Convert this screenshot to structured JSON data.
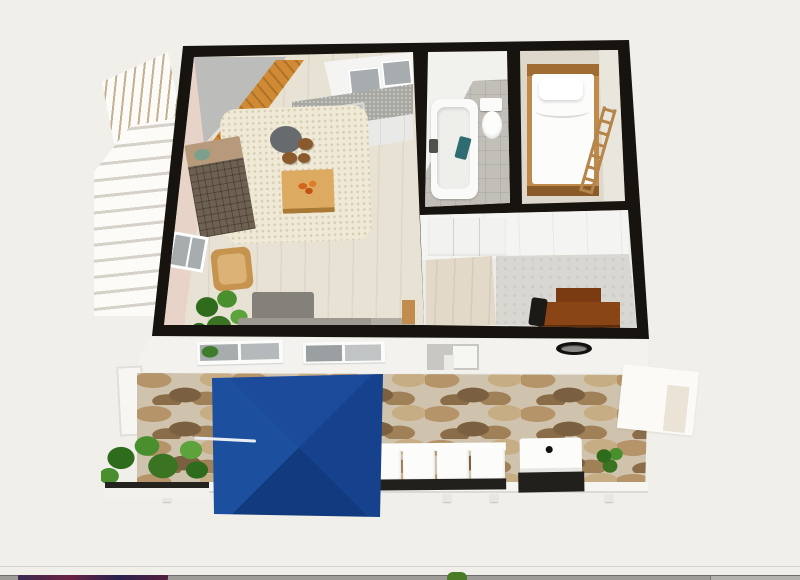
{
  "view": {
    "type": "3d-floor-plan-render",
    "background": "#f0efe9"
  },
  "colors": {
    "bg": "#f0efe9",
    "wall": "#17140f",
    "floor": "#e8e2d5",
    "pinkWall": "#e8d3c8",
    "ceiling": "#bcbcba",
    "stairs": "#cf8a33",
    "pergolaSlatGap": "#c2b193",
    "counter": "#a8a8a3",
    "cabinetFront": "#e9e9e7",
    "glass": "#a7adaf",
    "rug": "#efe9d6",
    "roundTable": "#686b6d",
    "stool": "#8a5a2c",
    "tableWood": "#dcaa60",
    "flowers": "#d4641c",
    "sideboardTop": "#b79a7c",
    "sideboardFront": "#6e6152",
    "sideboardPlant": "#7ca08c",
    "armchair": "#c79450",
    "plant": "#3a7423",
    "plantLight": "#5ba33a",
    "sofaBack": "#84807a",
    "sofaSeat": "#9d9890",
    "bathFloorTile": "#c2bfb9",
    "tub": "#fafaf8",
    "towel": "#2e6c72",
    "faucet": "#50504c",
    "bedroomFloor": "#ddd8cb",
    "bedFrame": "#c08a4c",
    "bedHead": "#a06c32",
    "duvet": "#fcfcfa",
    "ladder": "#b5854a",
    "officeWood": "#e2d9c8",
    "officeConcrete": "#d9d7d1",
    "desk": "#8a4516",
    "deskDark": "#7a3b12",
    "chair": "#1c1a17",
    "facade": "#f3f2ee",
    "vent": "#11100e",
    "stoneBase": "#cfc3ad",
    "stoneA": "#b5946a",
    "stoneB": "#7a5f41",
    "stoneC": "#c7ad84",
    "stoneD": "#8a6c49",
    "parasolTop": "#1c4b9b",
    "parasolLeft": "#1d4f9f",
    "parasolRight": "#16418c",
    "parasolBottom": "#123a7e",
    "railing": "#f6f5f1",
    "cushion": "#fcfcfa",
    "outdoorBase": "#22201c",
    "barStrip": "#9e9c99",
    "barFragment1": "#3a2a52",
    "barFragment2": "#6b2142",
    "barGreen": "#4a7c28"
  },
  "scene": {
    "rooms": [
      {
        "name": "living-room-kitchen",
        "furniture": [
          "interior-staircase",
          "kitchen-counter-with-sink",
          "kitchen-cabinets",
          "round-table",
          "bar-stools",
          "area-rug",
          "coffee-table-with-flowers",
          "sideboard",
          "wicker-armchair",
          "houseplants",
          "gray-sofa",
          "side-table",
          "left-window"
        ]
      },
      {
        "name": "bathroom",
        "furniture": [
          "bathtub",
          "faucet",
          "teal-towel",
          "toilet"
        ]
      },
      {
        "name": "bedroom",
        "furniture": [
          "single-bed",
          "pillow",
          "wooden-ladder"
        ]
      },
      {
        "name": "office-hallway",
        "furniture": [
          "closet",
          "wooden-desk",
          "desk-chair"
        ]
      },
      {
        "name": "terrace",
        "furniture": [
          "blue-parasol",
          "outdoor-sofa-white",
          "storage-box-grill",
          "planter-boxes",
          "bush",
          "railing",
          "stone-paving"
        ]
      }
    ],
    "exterior": [
      "pergola-slats",
      "exterior-staircase",
      "south-facade-windows",
      "facade-door",
      "round-vent",
      "white-awning"
    ]
  }
}
